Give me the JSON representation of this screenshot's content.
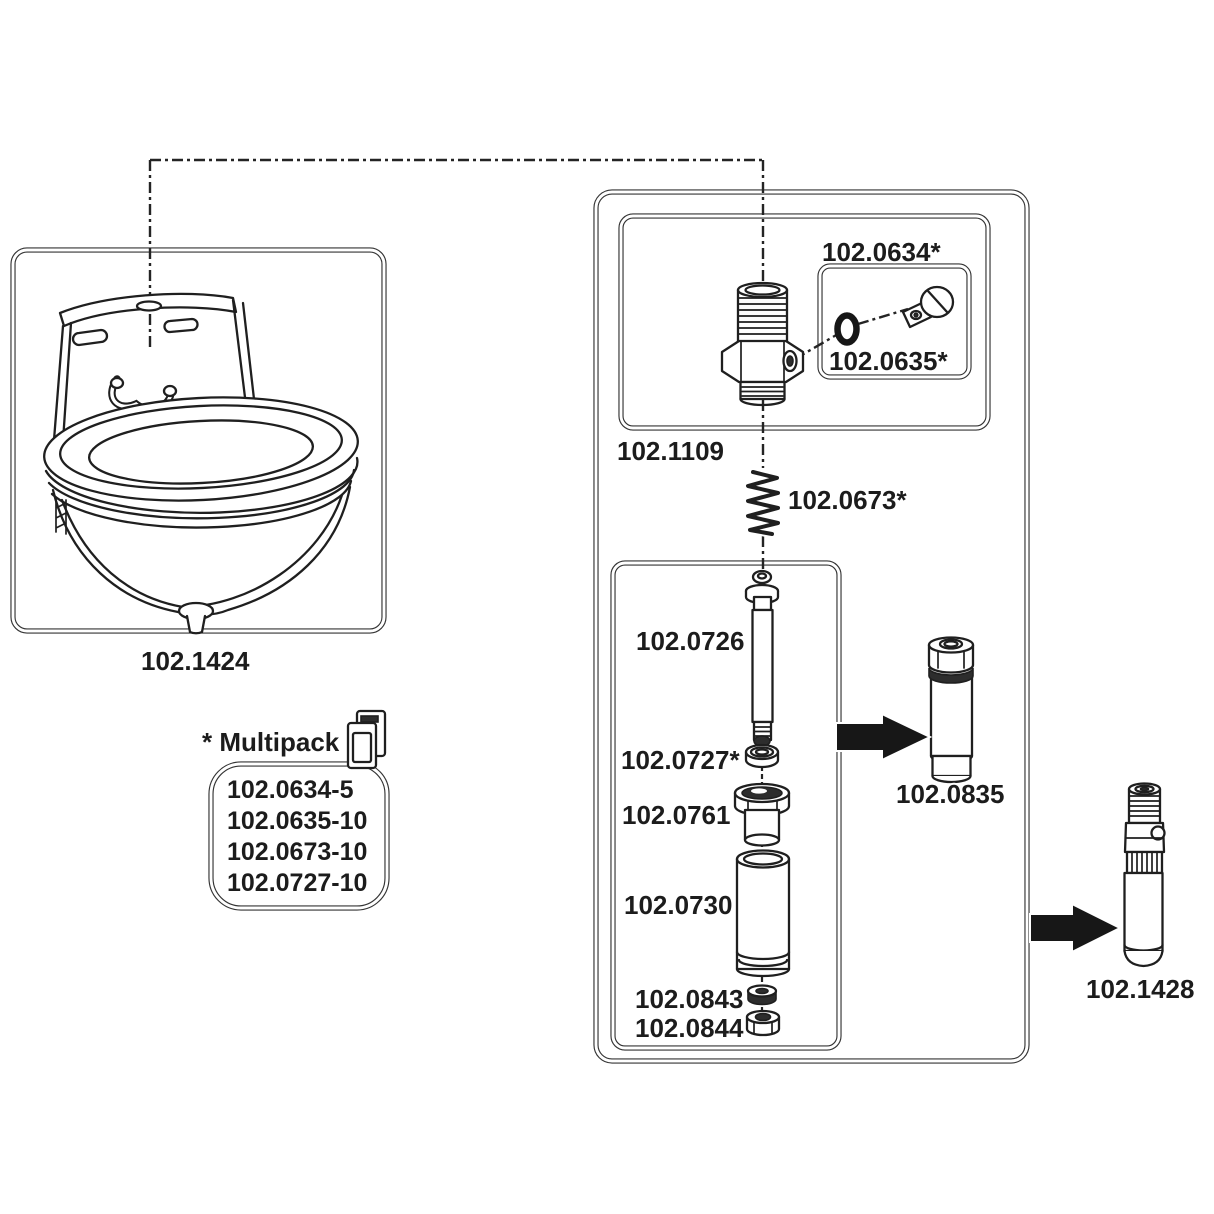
{
  "diagram": {
    "background": "#ffffff",
    "line_color": "#1f1f1f",
    "arrow_color": "#171717",
    "icons": {
      "multipack": "carton-icon",
      "flow_arrows": "arrow-right-icon"
    }
  },
  "bowl": {
    "label": "102.1424"
  },
  "multipack": {
    "title": "* Multipack",
    "items": [
      "102.0634-5",
      "102.0635-10",
      "102.0673-10",
      "102.0727-10"
    ]
  },
  "assembly": {
    "fitting_group_label": "102.1109",
    "service_kit_label": "102.0634*",
    "oring_screw_label": "102.0635*",
    "spring_label": "102.0673*",
    "pin_label": "102.0726",
    "seal_label": "102.0727*",
    "guide_label": "102.0761",
    "tube_label": "102.0730",
    "washer_label": "102.0843",
    "nut_label": "102.0844",
    "cartridge_label": "102.0835",
    "valve_complete_label": "102.1428"
  }
}
